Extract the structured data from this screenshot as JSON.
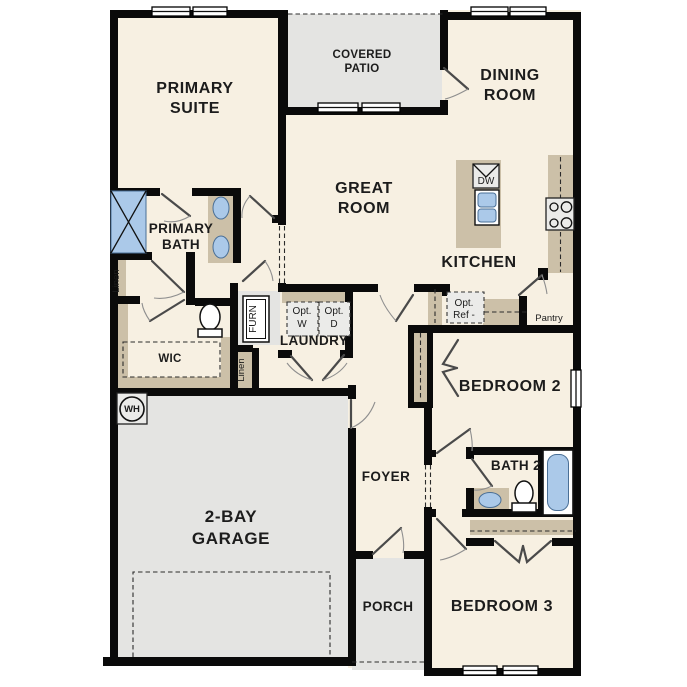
{
  "plan": {
    "labels": {
      "primary_suite": [
        "PRIMARY",
        "SUITE"
      ],
      "covered_patio": [
        "COVERED",
        "PATIO"
      ],
      "dining_room": [
        "DINING",
        "ROOM"
      ],
      "great_room": [
        "GREAT",
        "ROOM"
      ],
      "primary_bath": [
        "PRIMARY",
        "BATH"
      ],
      "kitchen": "KITCHEN",
      "laundry": "LAUNDRY",
      "wic": "WIC",
      "garage": [
        "2-BAY",
        "GARAGE"
      ],
      "foyer": "FOYER",
      "porch": "PORCH",
      "bedroom2": "BEDROOM 2",
      "bath2": "BATH 2",
      "bedroom3": "BEDROOM 3",
      "pantry": "Pantry",
      "dw": "DW",
      "opt_w": [
        "Opt.",
        "W"
      ],
      "opt_d": [
        "Opt.",
        "D"
      ],
      "opt_ref": [
        "Opt.",
        "Ref -"
      ],
      "furn": "FURN",
      "linen_primary": "Linen",
      "linen_hall": "Linen",
      "wh": "WH"
    },
    "colors": {
      "wall": "#0a0a0a",
      "interior": "#f7f0e2",
      "exterior": "#e4e4e2",
      "casework": "#ccc0a8",
      "fixture_blue": "#abc9e9",
      "fixture_blue_edge": "#4a6f96",
      "appliance": "#ebebe9",
      "door": "#4a4a4a",
      "arc": "#8f8f8f",
      "dash": "#2b2b2b",
      "label": "#1c1c1c"
    }
  }
}
